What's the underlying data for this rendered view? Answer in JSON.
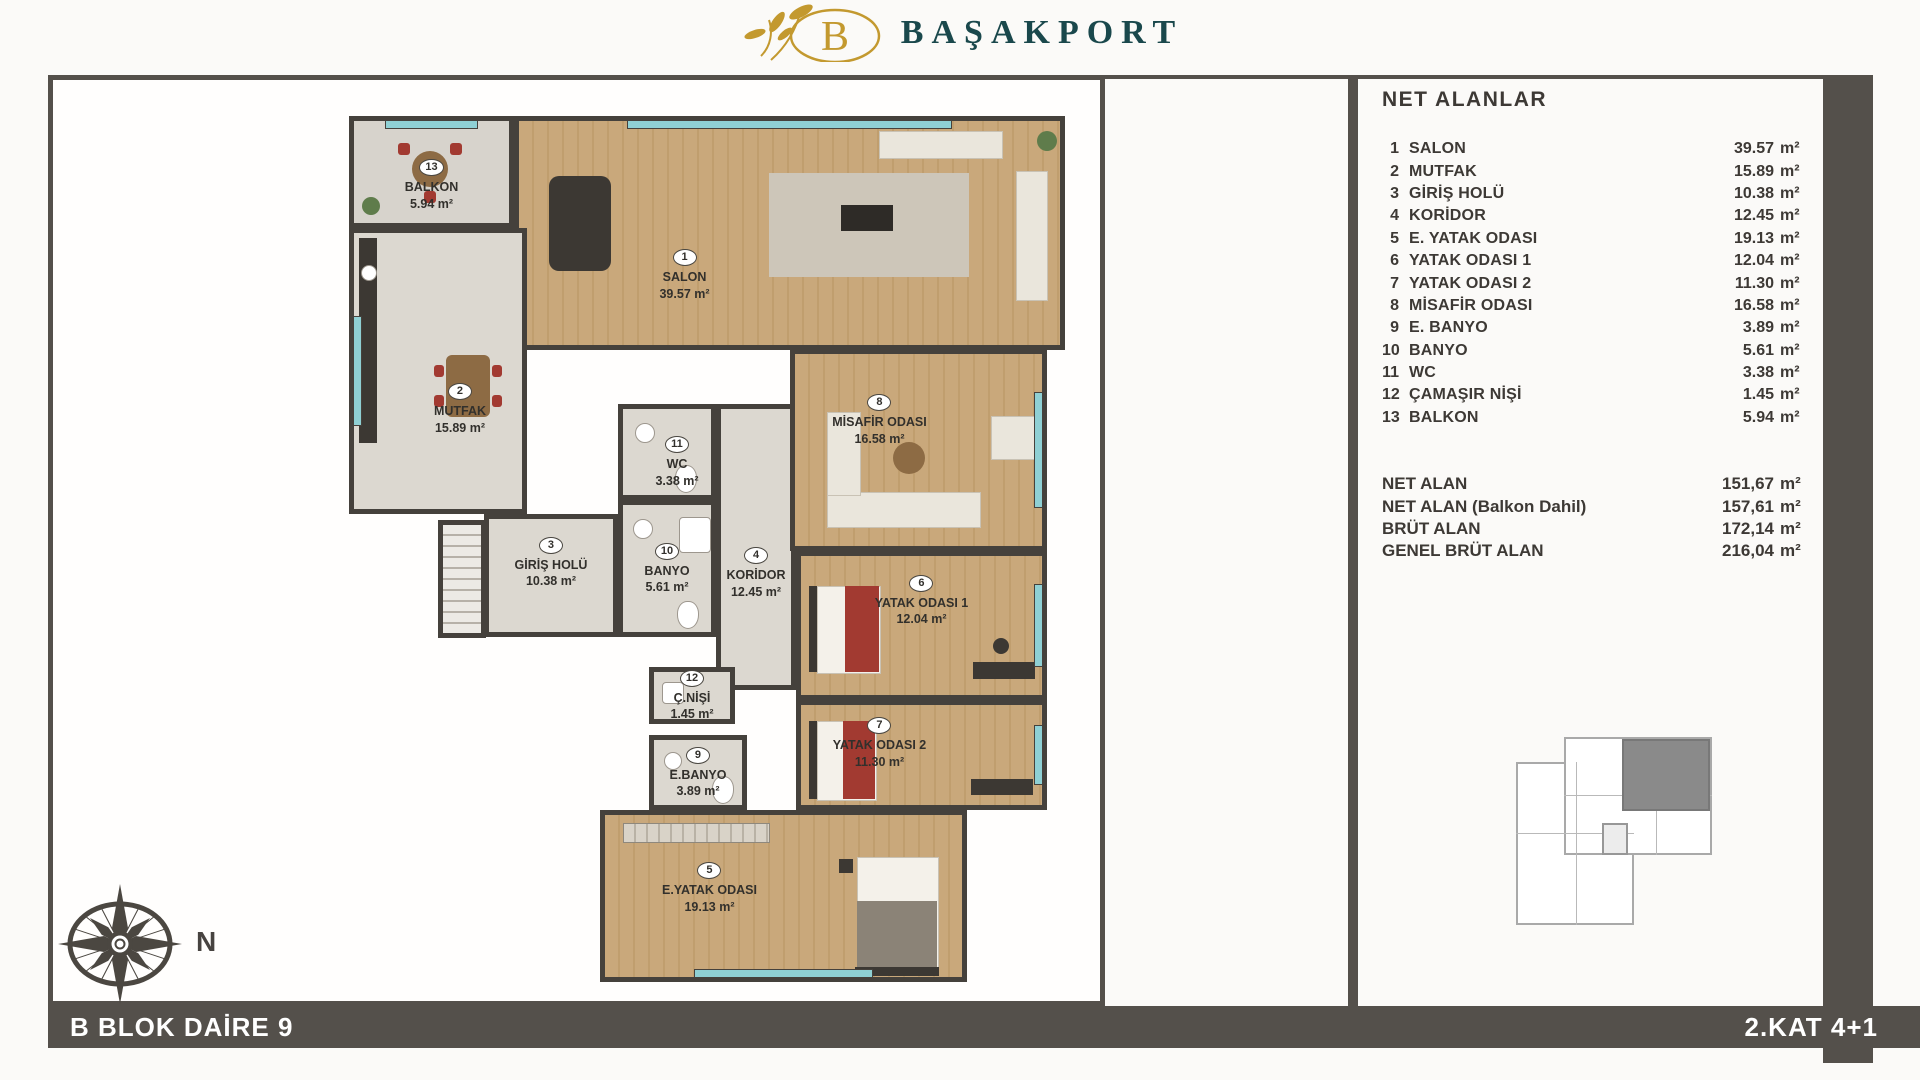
{
  "brand": {
    "logo_letter": "B",
    "name": "BAŞAKPORT"
  },
  "panel": {
    "title": "NET ALANLAR",
    "unit": "m²",
    "rows": [
      {
        "num": "1",
        "name": "SALON",
        "value": "39.57"
      },
      {
        "num": "2",
        "name": "MUTFAK",
        "value": "15.89"
      },
      {
        "num": "3",
        "name": "GİRİŞ HOLÜ",
        "value": "10.38"
      },
      {
        "num": "4",
        "name": "KORİDOR",
        "value": "12.45"
      },
      {
        "num": "5",
        "name": "E. YATAK ODASI",
        "plan_name": "E.YATAK ODASI",
        "value": "19.13"
      },
      {
        "num": "6",
        "name": "YATAK ODASI 1",
        "value": "12.04"
      },
      {
        "num": "7",
        "name": "YATAK ODASI 2",
        "value": "11.30"
      },
      {
        "num": "8",
        "name": "MİSAFİR ODASI",
        "value": "16.58"
      },
      {
        "num": "9",
        "name": "E. BANYO",
        "plan_name": "E.BANYO",
        "value": "3.89"
      },
      {
        "num": "10",
        "name": "BANYO",
        "value": "5.61"
      },
      {
        "num": "11",
        "name": "WC",
        "value": "3.38"
      },
      {
        "num": "12",
        "name": "ÇAMAŞIR NİŞİ",
        "plan_name": "Ç.NİŞİ",
        "value": "1.45"
      },
      {
        "num": "13",
        "name": "BALKON",
        "value": "5.94"
      }
    ],
    "summary": [
      {
        "label": "NET ALAN",
        "value": "151,67"
      },
      {
        "label": "NET ALAN (Balkon Dahil)",
        "value": "157,61"
      },
      {
        "label": "BRÜT ALAN",
        "value": "172,14"
      },
      {
        "label": "GENEL BRÜT ALAN",
        "value": "216,04"
      }
    ]
  },
  "footer": {
    "left": "B BLOK DAİRE 9",
    "right": "2.KAT 4+1"
  },
  "compass": {
    "label": "N"
  },
  "colors": {
    "bar_dark": "#54504b",
    "wall_dark": "#45413c",
    "logo_gold": "#c3992f",
    "brand_teal": "#1a484c",
    "wood_floor": "#c6a577",
    "tile_floor": "#dcd8d0",
    "bed_accent": "#a23a31",
    "window_glass": "#8fd0d4"
  }
}
